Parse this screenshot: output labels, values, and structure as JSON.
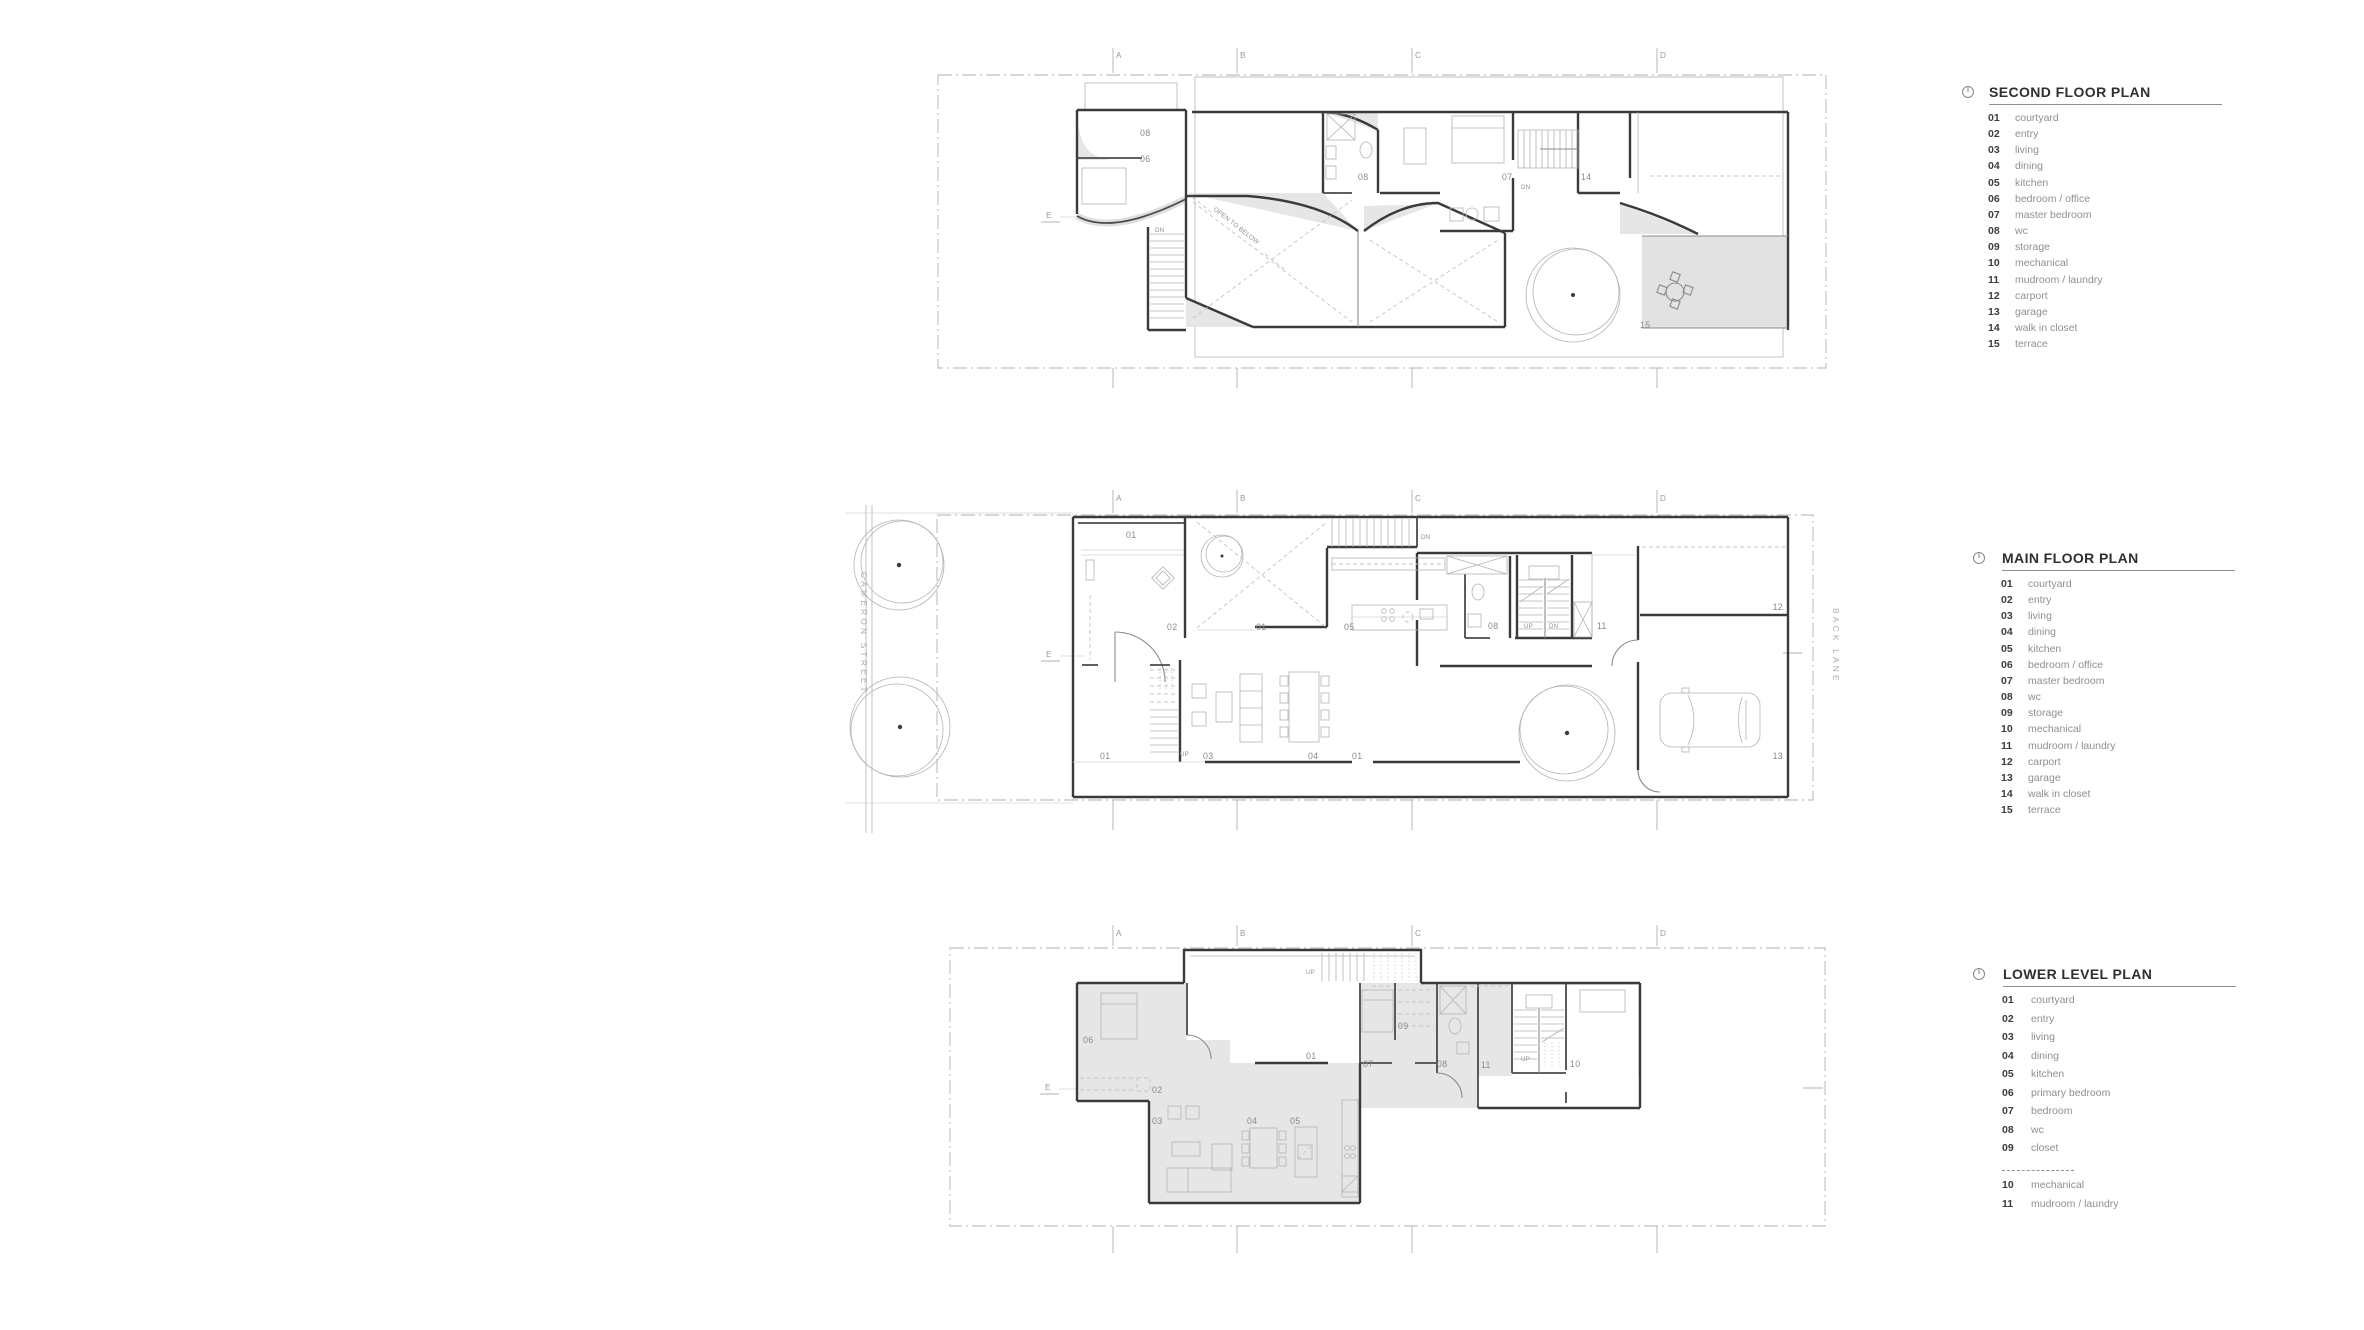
{
  "sheet": {
    "background": "#ffffff"
  },
  "colors": {
    "wall": "#3a3a3a",
    "thin_line": "#b3b3b3",
    "shade": "#e6e6e6",
    "room_label": "#8a8a8a",
    "legend_number": "#3c3c3c",
    "legend_label": "#8f8f8f",
    "legend_title": "#2f2f2f"
  },
  "legends": [
    {
      "id": "second-floor",
      "title": "SECOND FLOOR PLAN",
      "icon": "north-indicator",
      "row_height": 16.17,
      "items": [
        {
          "num": "01",
          "label": "courtyard"
        },
        {
          "num": "02",
          "label": "entry"
        },
        {
          "num": "03",
          "label": "living"
        },
        {
          "num": "04",
          "label": "dining"
        },
        {
          "num": "05",
          "label": "kitchen"
        },
        {
          "num": "06",
          "label": "bedroom / office"
        },
        {
          "num": "07",
          "label": "master bedroom"
        },
        {
          "num": "08",
          "label": "wc"
        },
        {
          "num": "09",
          "label": "storage"
        },
        {
          "num": "10",
          "label": "mechanical"
        },
        {
          "num": "11",
          "label": "mudroom / laundry"
        },
        {
          "num": "12",
          "label": "carport"
        },
        {
          "num": "13",
          "label": "garage"
        },
        {
          "num": "14",
          "label": "walk in closet"
        },
        {
          "num": "15",
          "label": "terrace"
        }
      ]
    },
    {
      "id": "main-floor",
      "title": "MAIN FLOOR PLAN",
      "icon": "north-indicator",
      "row_height": 16.17,
      "items": [
        {
          "num": "01",
          "label": "courtyard"
        },
        {
          "num": "02",
          "label": "entry"
        },
        {
          "num": "03",
          "label": "living"
        },
        {
          "num": "04",
          "label": "dining"
        },
        {
          "num": "05",
          "label": "kitchen"
        },
        {
          "num": "06",
          "label": "bedroom / office"
        },
        {
          "num": "07",
          "label": "master bedroom"
        },
        {
          "num": "08",
          "label": "wc"
        },
        {
          "num": "09",
          "label": "storage"
        },
        {
          "num": "10",
          "label": "mechanical"
        },
        {
          "num": "11",
          "label": "mudroom / laundry"
        },
        {
          "num": "12",
          "label": "carport"
        },
        {
          "num": "13",
          "label": "garage"
        },
        {
          "num": "14",
          "label": "walk in closet"
        },
        {
          "num": "15",
          "label": "terrace"
        }
      ]
    },
    {
      "id": "lower-level",
      "title": "LOWER LEVEL PLAN",
      "icon": "north-indicator",
      "row_height": 18.55,
      "items": [
        {
          "num": "01",
          "label": "courtyard"
        },
        {
          "num": "02",
          "label": "entry"
        },
        {
          "num": "03",
          "label": "living"
        },
        {
          "num": "04",
          "label": "dining"
        },
        {
          "num": "05",
          "label": "kitchen"
        },
        {
          "num": "06",
          "label": "primary bedroom"
        },
        {
          "num": "07",
          "label": "bedroom"
        },
        {
          "num": "08",
          "label": "wc"
        },
        {
          "num": "09",
          "label": "closet"
        },
        {
          "divider": true
        },
        {
          "num": "10",
          "label": "mechanical"
        },
        {
          "num": "11",
          "label": "mudroom / laundry"
        }
      ]
    }
  ],
  "plans": [
    {
      "id": "second-floor-plan",
      "grid_letters": [
        {
          "t": "A",
          "x": 1116,
          "y": 58
        },
        {
          "t": "B",
          "x": 1240,
          "y": 58
        },
        {
          "t": "C",
          "x": 1415,
          "y": 58
        },
        {
          "t": "D",
          "x": 1660,
          "y": 58
        },
        {
          "t": "E",
          "x": 1046,
          "y": 218
        }
      ],
      "room_labels": [
        {
          "t": "08",
          "x": 1140,
          "y": 136
        },
        {
          "t": "06",
          "x": 1140,
          "y": 162
        },
        {
          "t": "08",
          "x": 1358,
          "y": 180
        },
        {
          "t": "07",
          "x": 1502,
          "y": 180
        },
        {
          "t": "14",
          "x": 1581,
          "y": 180
        },
        {
          "t": "15",
          "x": 1640,
          "y": 328
        }
      ],
      "annotations": [
        {
          "t": "DN",
          "x": 1155,
          "y": 232
        },
        {
          "t": "DN",
          "x": 1521,
          "y": 189
        },
        {
          "t": "OPEN TO BELOW",
          "x": 1213,
          "y": 210,
          "rotate": 38,
          "size": 6.4
        }
      ]
    },
    {
      "id": "main-floor-plan",
      "grid_letters": [
        {
          "t": "A",
          "x": 1116,
          "y": 501
        },
        {
          "t": "B",
          "x": 1240,
          "y": 501
        },
        {
          "t": "C",
          "x": 1415,
          "y": 501
        },
        {
          "t": "D",
          "x": 1660,
          "y": 501
        },
        {
          "t": "E",
          "x": 1046,
          "y": 657
        }
      ],
      "room_labels": [
        {
          "t": "01",
          "x": 1126,
          "y": 538
        },
        {
          "t": "02",
          "x": 1167,
          "y": 630
        },
        {
          "t": "01",
          "x": 1256,
          "y": 630
        },
        {
          "t": "05",
          "x": 1344,
          "y": 630
        },
        {
          "t": "08",
          "x": 1488,
          "y": 629
        },
        {
          "t": "11",
          "x": 1597,
          "y": 629
        },
        {
          "t": "12",
          "x": 1783,
          "y": 610,
          "anchor": "end"
        },
        {
          "t": "13",
          "x": 1783,
          "y": 759,
          "anchor": "end"
        },
        {
          "t": "01",
          "x": 1100,
          "y": 759
        },
        {
          "t": "03",
          "x": 1203,
          "y": 759
        },
        {
          "t": "04",
          "x": 1308,
          "y": 759
        },
        {
          "t": "01",
          "x": 1352,
          "y": 759
        }
      ],
      "annotations": [
        {
          "t": "DN",
          "x": 1421,
          "y": 539
        },
        {
          "t": "UP",
          "x": 1524,
          "y": 628
        },
        {
          "t": "DN",
          "x": 1549,
          "y": 628
        },
        {
          "t": "UP",
          "x": 1180,
          "y": 756
        }
      ],
      "street_labels": [
        {
          "t": "CAMERON STREET",
          "x": 861,
          "y": 572,
          "rotate": 90
        },
        {
          "t": "BACK LANE",
          "x": 1833,
          "y": 608,
          "rotate": 90
        }
      ]
    },
    {
      "id": "lower-level-plan",
      "grid_letters": [
        {
          "t": "A",
          "x": 1116,
          "y": 936
        },
        {
          "t": "B",
          "x": 1240,
          "y": 936
        },
        {
          "t": "C",
          "x": 1415,
          "y": 936
        },
        {
          "t": "D",
          "x": 1660,
          "y": 936
        },
        {
          "t": "E",
          "x": 1045,
          "y": 1090
        }
      ],
      "room_labels": [
        {
          "t": "06",
          "x": 1083,
          "y": 1043
        },
        {
          "t": "02",
          "x": 1152,
          "y": 1093
        },
        {
          "t": "03",
          "x": 1152,
          "y": 1124
        },
        {
          "t": "04",
          "x": 1247,
          "y": 1124
        },
        {
          "t": "05",
          "x": 1290,
          "y": 1124
        },
        {
          "t": "01",
          "x": 1306,
          "y": 1059
        },
        {
          "t": "07",
          "x": 1363,
          "y": 1067
        },
        {
          "t": "09",
          "x": 1398,
          "y": 1029
        },
        {
          "t": "08",
          "x": 1437,
          "y": 1067
        },
        {
          "t": "11",
          "x": 1481,
          "y": 1068
        },
        {
          "t": "10",
          "x": 1570,
          "y": 1067
        }
      ],
      "annotations": [
        {
          "t": "UP",
          "x": 1306,
          "y": 974
        },
        {
          "t": "UP",
          "x": 1521,
          "y": 1061
        }
      ]
    }
  ]
}
